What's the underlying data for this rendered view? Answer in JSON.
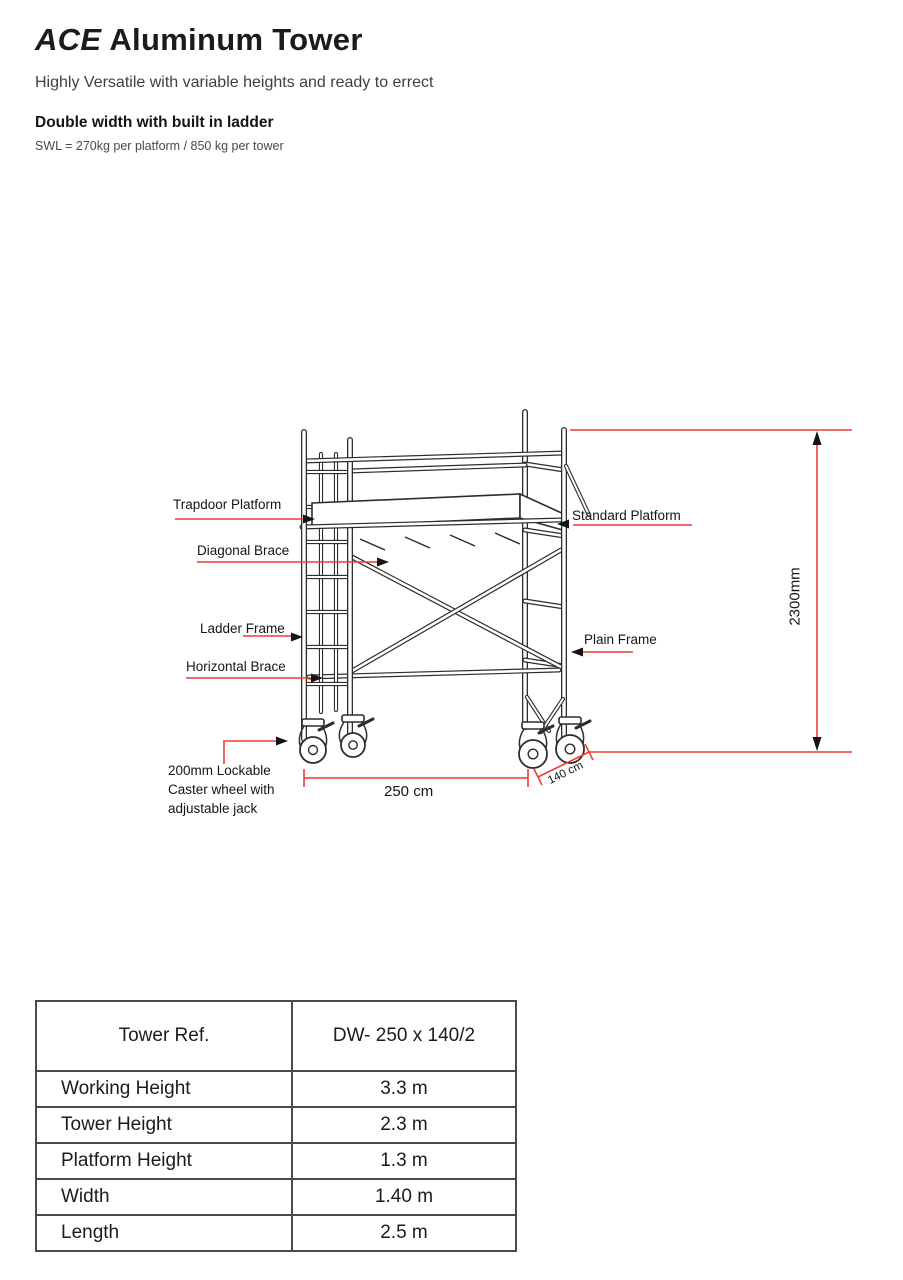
{
  "header": {
    "title_italic": "ACE",
    "title_rest": "Aluminum Tower",
    "subtitle": "Highly Versatile with variable heights and ready to errect",
    "product_line": "Double width with built in ladder",
    "swl": "SWL = 270kg per platform / 850 kg per tower"
  },
  "diagram": {
    "labels": {
      "trapdoor_platform": "Trapdoor Platform",
      "standard_platform": "Standard Platform",
      "diagonal_brace": "Diagonal Brace",
      "ladder_frame": "Ladder Frame",
      "plain_frame": "Plain Frame",
      "horizontal_brace": "Horizontal Brace",
      "caster": "200mm Lockable\nCaster wheel with\nadjustable jack"
    },
    "dimensions": {
      "tower_height": "2300mm",
      "length": "250 cm",
      "width": "140 cm"
    },
    "colors": {
      "dimension_red": "#ee3c32",
      "line_dark": "#2d2d2d"
    }
  },
  "spec_table": {
    "header": {
      "label": "Tower Ref.",
      "value": "DW- 250 x 140/2"
    },
    "rows": [
      {
        "label": "Working Height",
        "value": "3.3 m"
      },
      {
        "label": "Tower Height",
        "value": "2.3 m"
      },
      {
        "label": "Platform Height",
        "value": "1.3 m"
      },
      {
        "label": "Width",
        "value": "1.40 m"
      },
      {
        "label": "Length",
        "value": "2.5 m"
      }
    ]
  }
}
